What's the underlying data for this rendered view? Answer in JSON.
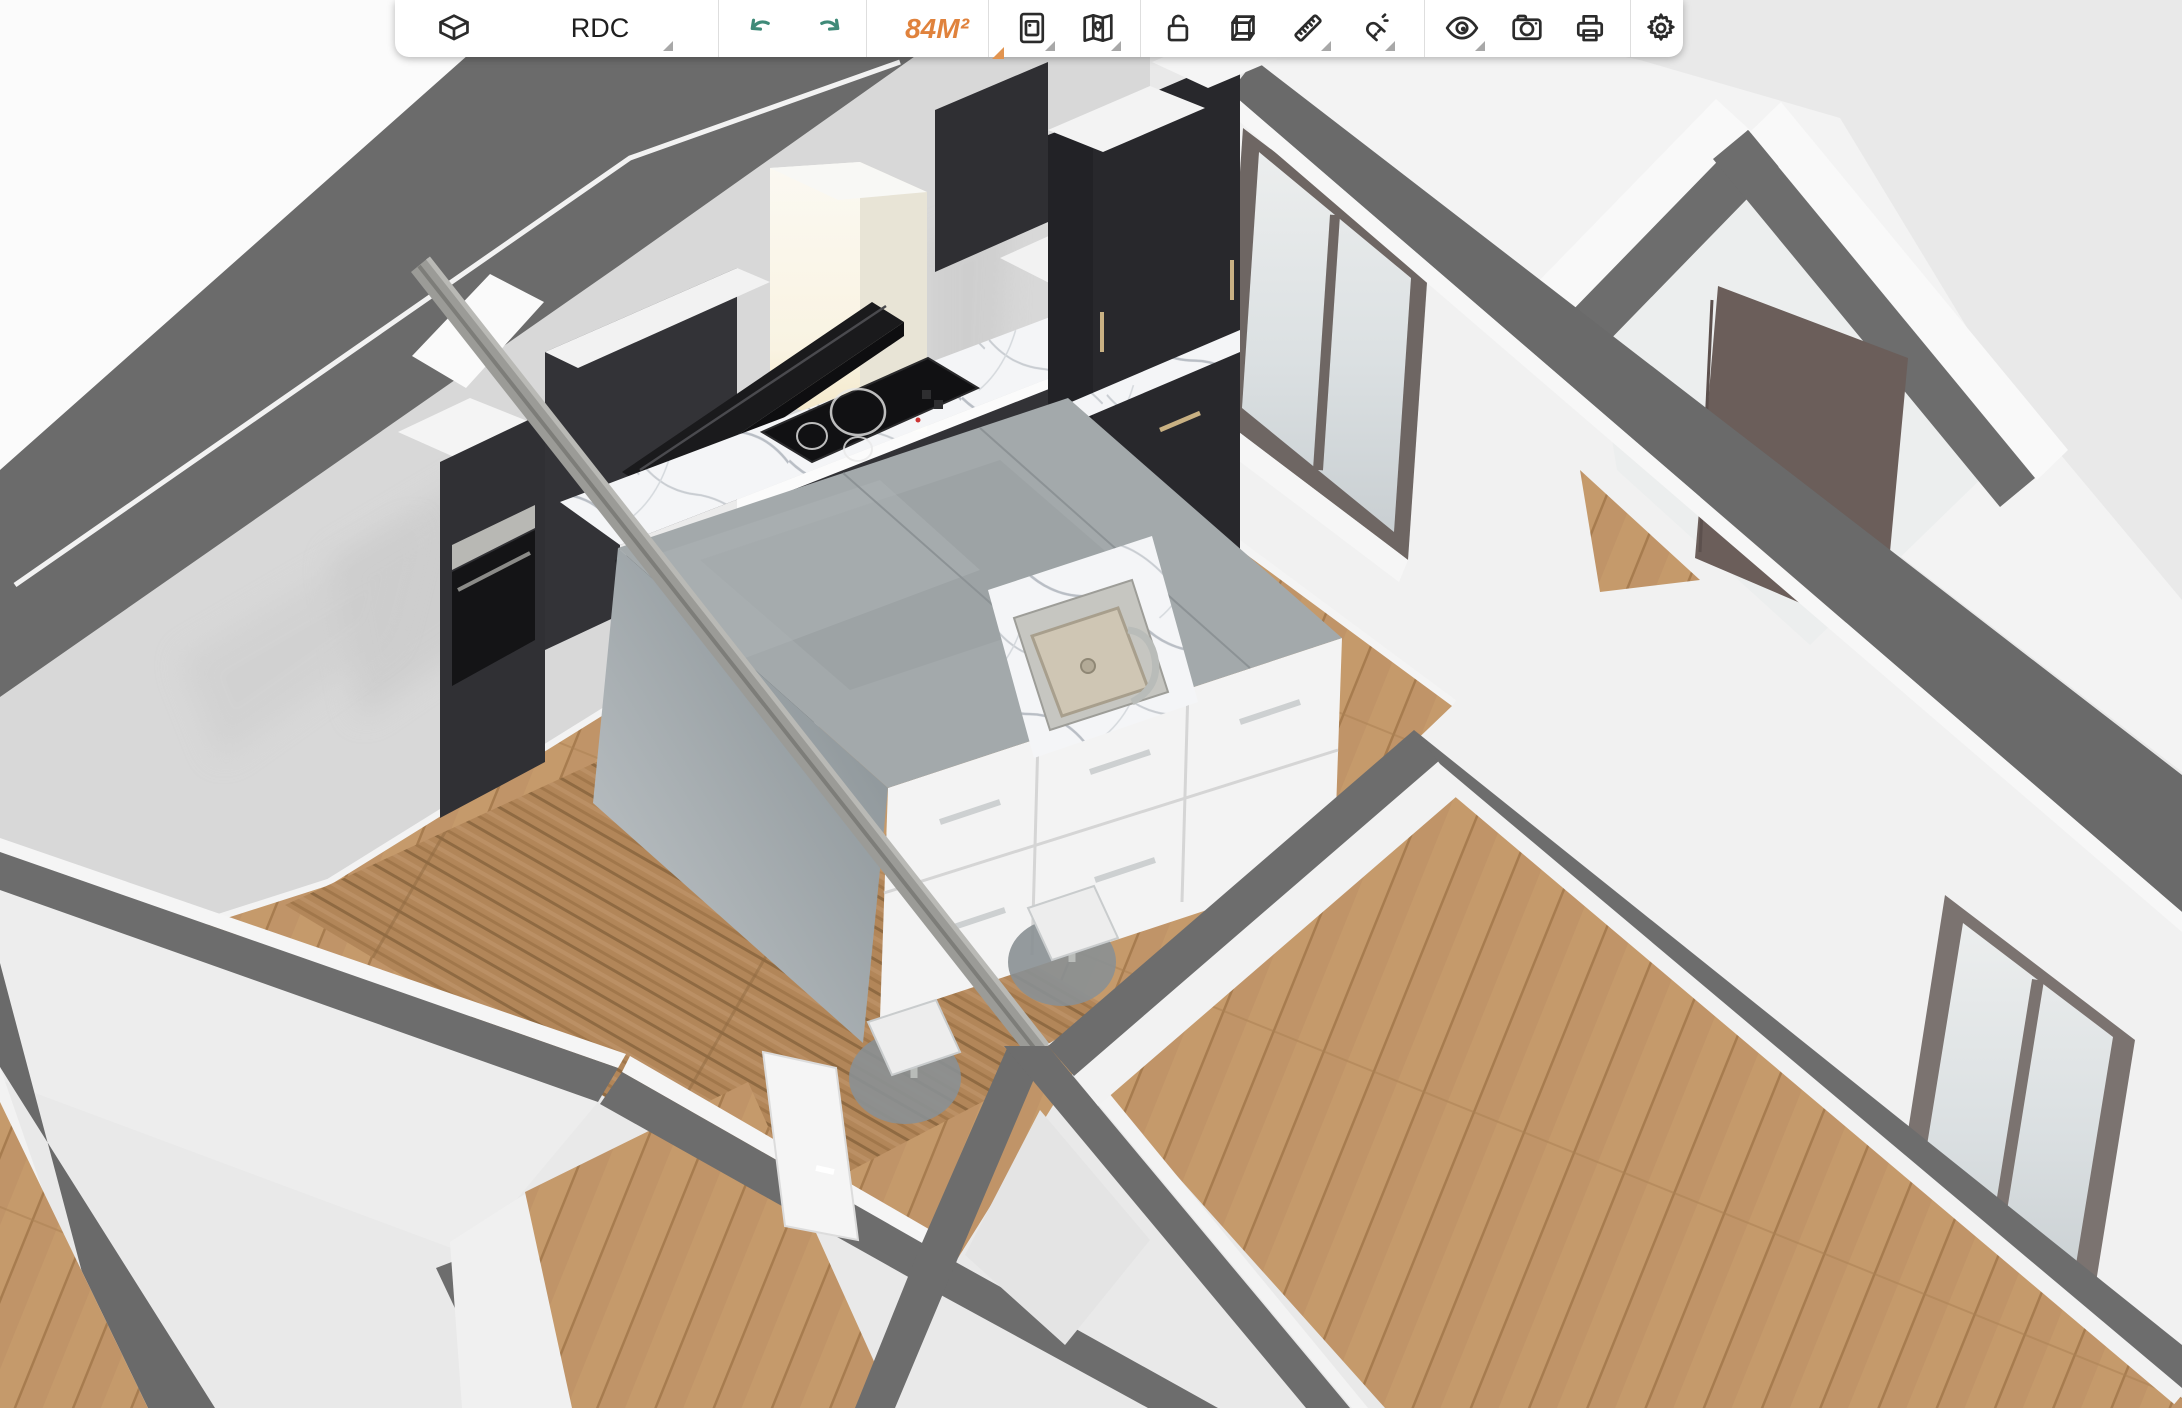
{
  "app": {
    "kind": "3d-floor-planner"
  },
  "toolbar": {
    "view_button": {
      "icon": "box-3d-icon"
    },
    "floor_selector": {
      "label": "RDC",
      "has_dropdown": true
    },
    "history": {
      "undo_icon": "undo-arrow-icon",
      "redo_icon": "redo-arrow-icon"
    },
    "area_badge": {
      "label": "84M²",
      "has_dropdown": true
    },
    "tools": [
      {
        "name": "snapshot",
        "icon": "photo-icon",
        "has_dropdown": true
      },
      {
        "name": "plan",
        "icon": "map-icon",
        "has_dropdown": true
      },
      {
        "name": "lock",
        "icon": "open-lock-icon",
        "has_dropdown": false
      },
      {
        "name": "box-view",
        "icon": "cube-icon",
        "has_dropdown": false
      },
      {
        "name": "measure",
        "icon": "ruler-icon",
        "has_dropdown": true
      },
      {
        "name": "snap",
        "icon": "magnet-icon",
        "has_dropdown": true
      },
      {
        "name": "visibility",
        "icon": "eye-icon",
        "has_dropdown": true
      },
      {
        "name": "camera",
        "icon": "camera-icon",
        "has_dropdown": false
      },
      {
        "name": "print",
        "icon": "printer-icon",
        "has_dropdown": false
      },
      {
        "name": "settings",
        "icon": "gear-icon",
        "has_dropdown": false
      }
    ]
  },
  "colors": {
    "background": "#e9e9e9",
    "accent_orange": "#e0823c",
    "accent_teal": "#3f8a78",
    "wall_top_gray": "#6a6a6a",
    "wall_white": "#f3f3f3",
    "interior_wall_gray": "#d8d8d8",
    "wood_floor": "#c59a6b",
    "rug_wood": "#b28659",
    "cabinet_dark": "#303034",
    "marble": "#f4f5f7",
    "island_concrete": "#a3a9ab",
    "door_brown": "#6b5e5a",
    "window_frame_taupe": "#7b7370",
    "handle_champagne": "#c9b183",
    "steel": "#b9bcb9"
  },
  "scene": {
    "objects": [
      "kitchen-tall-oven-column",
      "kitchen-cabinets",
      "range-hood",
      "induction-hob",
      "marble-countertop",
      "kitchen-island",
      "island-sink",
      "island-faucet",
      "bar-stool",
      "bar-stool",
      "ceiling-beam",
      "entry-door",
      "open-interior-door",
      "window",
      "window",
      "area-rug",
      "wood-floor",
      "wall-tops"
    ]
  }
}
